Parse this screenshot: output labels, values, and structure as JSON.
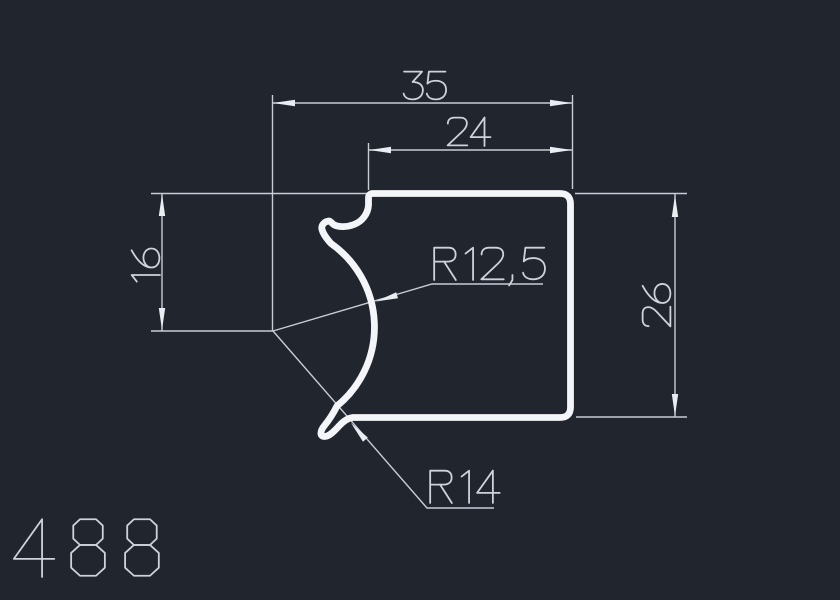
{
  "title": {
    "value": "488",
    "description": "Profile 488 cross-section drawing"
  },
  "colors": {
    "background": "#20252e",
    "dimension_lines": "#c7ccd5",
    "profile_outline": "#f3f5f8",
    "arrowheads": "#e9ecf0",
    "text": "#ced3da"
  },
  "profile": {
    "number": "488"
  },
  "dimensions": {
    "overall_width": {
      "label": "35"
    },
    "top_width": {
      "label": "24"
    },
    "left_height": {
      "label": "16"
    },
    "right_height": {
      "label": "26"
    },
    "radius_inner": {
      "label": "R12,5"
    },
    "radius_outer": {
      "label": "R14"
    }
  },
  "drawing_texts": [
    {
      "name": "dim-text-overall-width",
      "value": "35",
      "x": 403,
      "y": 100,
      "size": 29,
      "rotate": 0
    },
    {
      "name": "dim-text-top-width",
      "value": "24",
      "x": 447,
      "y": 146,
      "size": 29,
      "rotate": 0
    },
    {
      "name": "dim-text-left-height",
      "value": "16",
      "x": 160,
      "y": 287,
      "size": 29,
      "rotate": -90
    },
    {
      "name": "dim-text-right-height",
      "value": "26",
      "x": 671,
      "y": 327,
      "size": 29,
      "rotate": -90
    },
    {
      "name": "radius-text-r12-5",
      "value": "R12,5",
      "x": 433,
      "y": 280,
      "size": 33,
      "rotate": 0
    },
    {
      "name": "radius-text-r14",
      "value": "R14",
      "x": 429,
      "y": 503,
      "size": 33,
      "rotate": 0
    },
    {
      "name": "profile-number-text",
      "value": "488",
      "x": 13,
      "y": 577,
      "size": 59,
      "rotate": 0,
      "advance": 12.8
    }
  ]
}
